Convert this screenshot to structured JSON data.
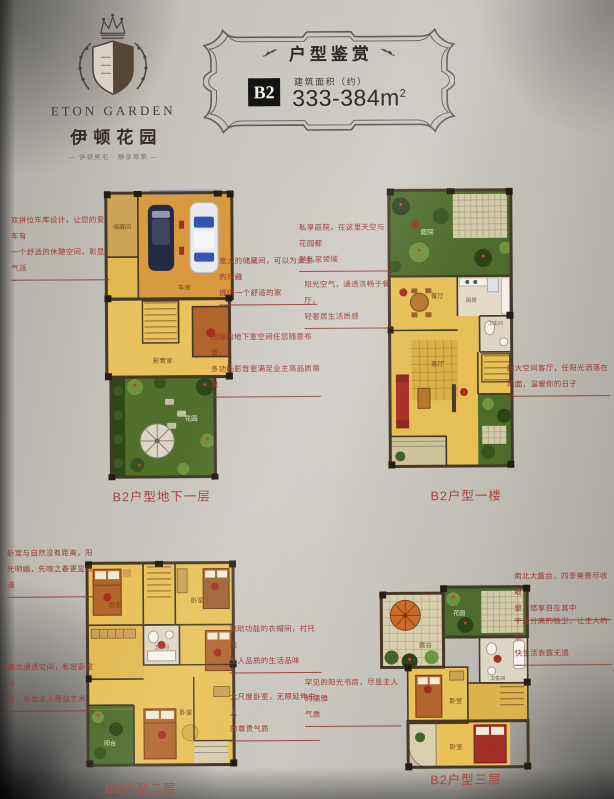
{
  "logo": {
    "name_en": "ETON  GARDEN",
    "name_cn": "伊顿花园",
    "tagline": "— 伊顿美宅 · 静享尊荣 —"
  },
  "badge": {
    "title": "户型鉴赏",
    "unit": "B2",
    "area_label": "建筑面积（约）",
    "area_value": "333-384m",
    "area_sup": "2"
  },
  "colors": {
    "accent_red": "#9c382f",
    "caption_red": "#a6453b",
    "badge_black": "#141412",
    "floor_yellow": "#e8c158",
    "garden_green": "#4d6c2b"
  },
  "plans": {
    "basement": {
      "caption": "B2户型地下一层",
      "rooms": {
        "r1": "储藏间",
        "r2": "车库",
        "r3": "影音室",
        "r4": "花园"
      }
    },
    "first": {
      "caption": "B2户型一楼",
      "rooms": {
        "r1": "庭院",
        "r2": "餐厅",
        "r3": "厨房",
        "r4": "卫生间",
        "r5": "客厅"
      }
    },
    "second": {
      "caption": "B2户型二层",
      "rooms": {
        "r1": "卧室",
        "r2": "卧室",
        "r3": "卫生间",
        "r4": "卧室",
        "r5": "阳台"
      }
    },
    "third": {
      "caption": "B2户型三层",
      "rooms": {
        "r1": "露台",
        "r2": "花园",
        "r3": "卧室",
        "r4": "卫生间",
        "r5": "卧室"
      }
    }
  },
  "annotations": {
    "a1": {
      "l1": "双拼位车库设计，让您的爱车有",
      "l2": "一个舒适的休憩空间，彰显气派"
    },
    "a2": {
      "l1": "宽大的储藏间，可以为业主的珍藏",
      "l2": "提供一个舒适的家"
    },
    "a3": {
      "l1": "阔绰的地下室空间任您随意布置，",
      "l2": "多功能影音室满足业主高品质需求"
    },
    "a4": {
      "l1": "私享庭院，在这里天空与花园都",
      "l2": "是私家领域"
    },
    "a5": {
      "l1": "阳光空气，通透流畅于餐厅，",
      "l2": "轻奢居生活质感"
    },
    "a6": {
      "l1": "超大空间客厅，任阳光洒落在",
      "l2": "地面，温暖你的日子"
    },
    "a7": {
      "l1": "卧室与自然没有距离，阳",
      "l2": "光明媚，先嗅之春更显浪漫"
    },
    "a8": {
      "l1": "南北通透空间，私密卧室设",
      "l2": "计，彰显主人居住艺术"
    },
    "a9": {
      "l1": "辅助功能的衣帽间，衬托出",
      "l2": "主人品质的生活品味"
    },
    "a10": {
      "l1": "大尺度卧室，无限延伸主人",
      "l2": "的尊贵气质"
    },
    "a11": {
      "l1": "罕见的阳光书房，尽显主人的儒雅",
      "l2": "气质"
    },
    "a12": {
      "l1": "南北大露台，四季美景尽收眼",
      "l2": "里，悠享自在其中"
    },
    "a13": {
      "l1": "干湿分离的独卫，让主人的愉",
      "l2": "快生活表露无遗"
    }
  }
}
